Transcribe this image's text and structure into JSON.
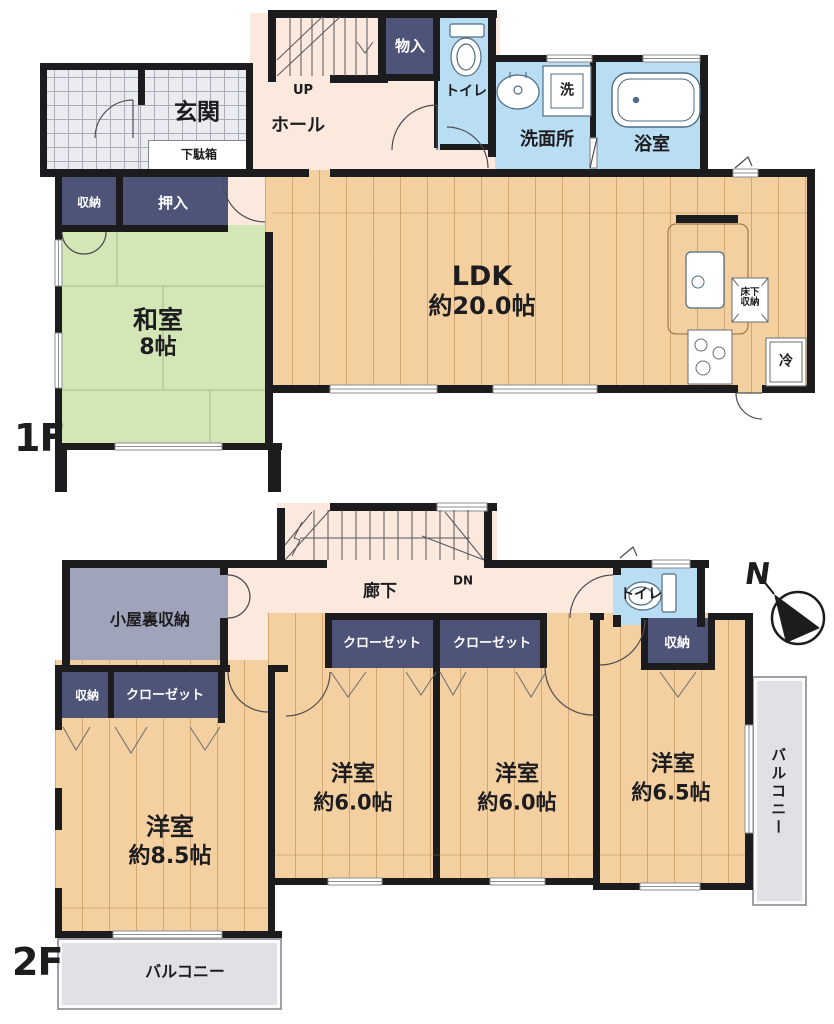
{
  "floor1": {
    "label": "1F",
    "genkan": "玄関",
    "getabako": "下駄箱",
    "hall": "ホール",
    "up": "UP",
    "monoire": "物入",
    "toilet": "トイレ",
    "senmenjo": "洗面所",
    "washer": "洗",
    "bathroom": "浴室",
    "storage": "収納",
    "oshiire": "押入",
    "washitsu": {
      "name": "和室",
      "size": "8帖"
    },
    "ldk": {
      "name": "LDK",
      "size": "約20.0帖"
    },
    "underfloor_storage": "床下収納",
    "fridge": "冷"
  },
  "floor2": {
    "label": "2F",
    "attic_storage": "小屋裏収納",
    "corridor": "廊下",
    "dn": "DN",
    "toilet": "トイレ",
    "closet": "クローゼット",
    "storage": "収納",
    "room1": {
      "name": "洋室",
      "size": "約8.5帖"
    },
    "room2": {
      "name": "洋室",
      "size": "約6.0帖"
    },
    "room3": {
      "name": "洋室",
      "size": "約6.0帖"
    },
    "room4": {
      "name": "洋室",
      "size": "約6.5帖"
    },
    "balcony": "バルコニー"
  },
  "compass": {
    "north": "N"
  },
  "palette": {
    "wall": "#1c1c1e",
    "wood_floor": "#f4d0a1",
    "tatami": "#d3e6b6",
    "closet_navy": "#4d5478",
    "wet_blue": "#b9ddf3",
    "hall_pink": "#fbe9dd",
    "balcony_gray": "#e0e1e4"
  }
}
